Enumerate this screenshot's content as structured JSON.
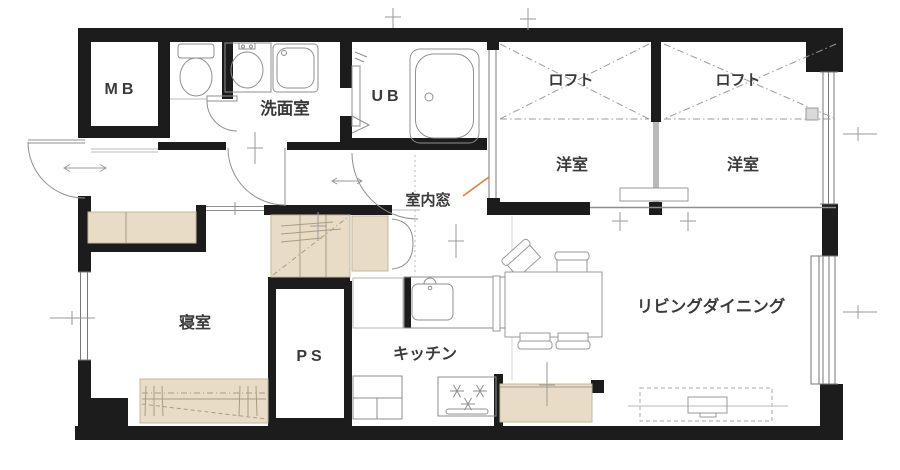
{
  "plan_type": "apartment-floor-plan",
  "rooms": {
    "mb": {
      "label": "MB"
    },
    "washroom": {
      "label": "洗面室"
    },
    "ub": {
      "label": "UB"
    },
    "loft_left": {
      "label": "ロフト"
    },
    "loft_right": {
      "label": "ロフト"
    },
    "western_left": {
      "label": "洋室"
    },
    "western_right": {
      "label": "洋室"
    },
    "bedroom": {
      "label": "寝室"
    },
    "ps": {
      "label": "PS"
    },
    "kitchen": {
      "label": "キッチン"
    },
    "living_dining": {
      "label": "リビングダイニング"
    }
  },
  "annotations": {
    "interior_window": {
      "label": "室内窓",
      "color": "#e8793a"
    }
  },
  "colors": {
    "wall": "#1c1c1c",
    "fixture_line": "#8f8f8f",
    "storage_fill": "#e9dcc6",
    "storage_border": "#c3b79d",
    "accent_orange": "#e8793a"
  }
}
